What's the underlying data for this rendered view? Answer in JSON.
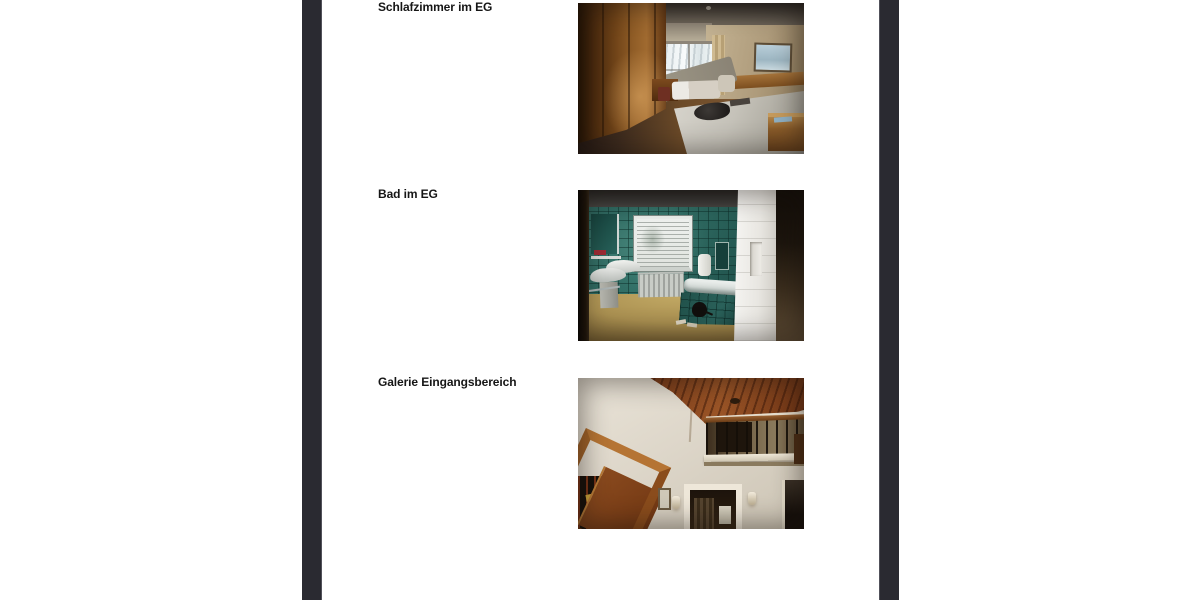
{
  "viewer": {
    "backdrop_color": "#2a2a31",
    "page_color": "#ffffff"
  },
  "rows": [
    {
      "label": "Schlafzimmer im EG",
      "photo_subject": "bedroom-ground-floor"
    },
    {
      "label": "Bad im EG",
      "photo_subject": "bathroom-ground-floor"
    },
    {
      "label": "Galerie Eingangsbereich",
      "photo_subject": "entrance-gallery"
    }
  ]
}
